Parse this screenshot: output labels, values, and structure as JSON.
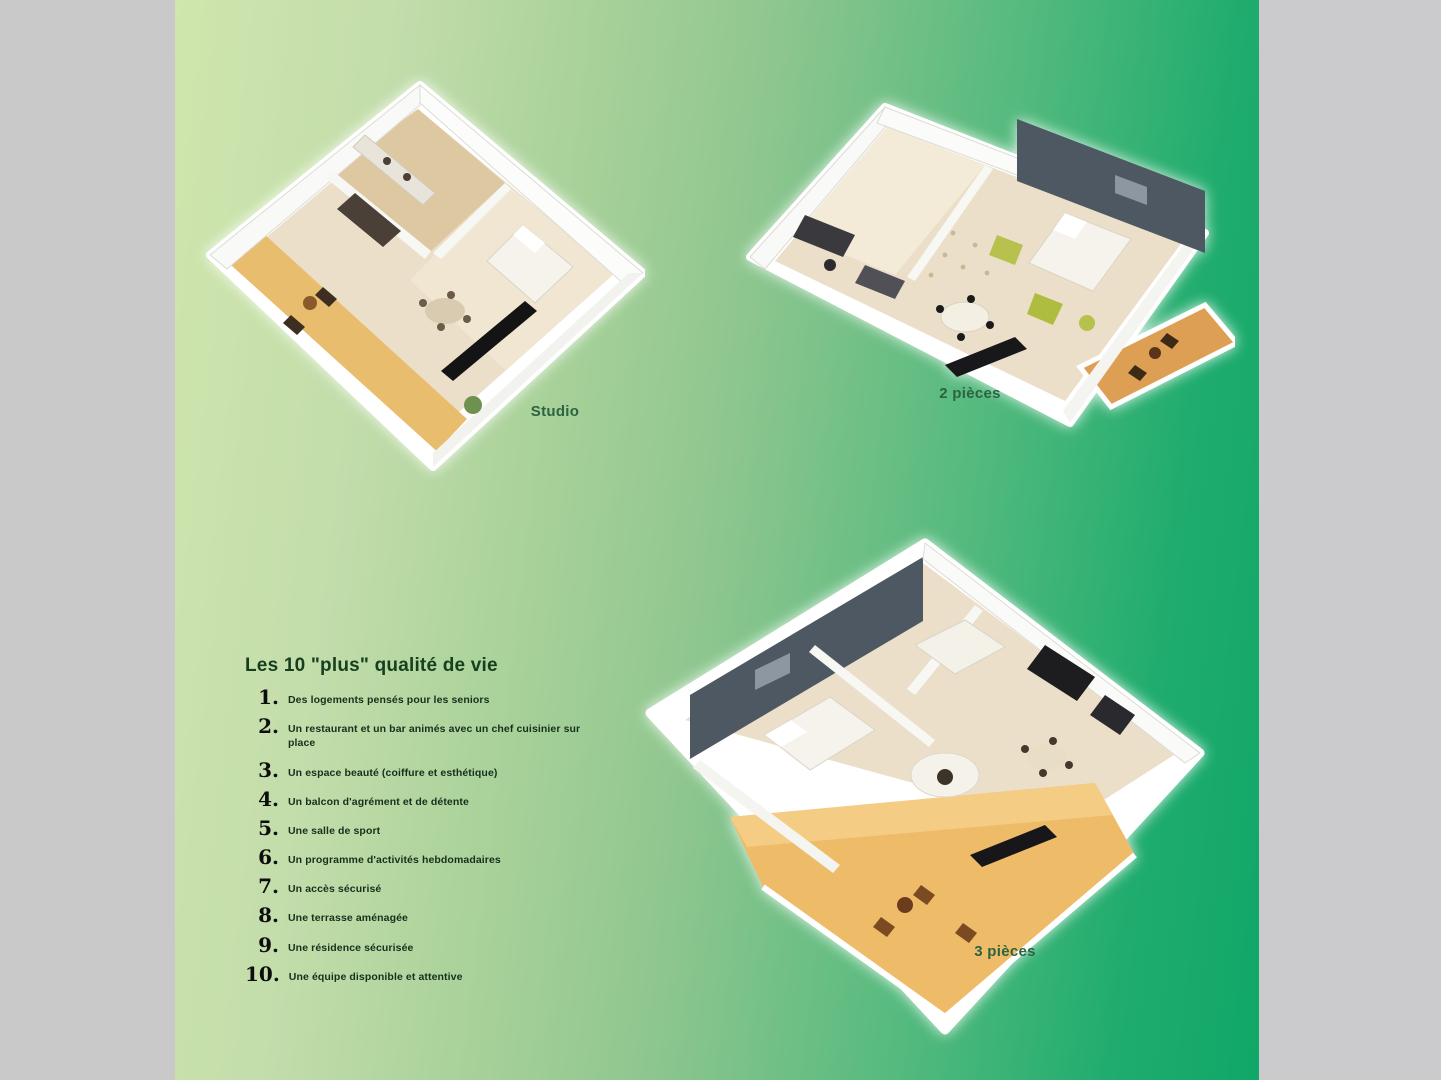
{
  "page": {
    "background_color": "#c9c9c9",
    "panel_gradient_left": "#cfe6ac",
    "panel_gradient_mid": "#8ec68f",
    "panel_gradient_right": "#10a768",
    "right_margin_color": "#cbcacd"
  },
  "plans": [
    {
      "id": "studio",
      "label": "Studio"
    },
    {
      "id": "2-pieces",
      "label": "2 pièces"
    },
    {
      "id": "3-pieces",
      "label": "3 pièces"
    }
  ],
  "features": {
    "title": "Les 10 \"plus\" qualité de vie",
    "items": [
      {
        "num": "1.",
        "text": "Des logements pensés pour les seniors"
      },
      {
        "num": "2.",
        "text": "Un restaurant et un bar animés avec un chef cuisinier sur place"
      },
      {
        "num": "3.",
        "text": "Un espace beauté (coiffure et esthétique)"
      },
      {
        "num": "4.",
        "text": "Un balcon d'agrément et de détente"
      },
      {
        "num": "5.",
        "text": "Une salle de sport"
      },
      {
        "num": "6.",
        "text": "Un programme d'activités hebdomadaires"
      },
      {
        "num": "7.",
        "text": "Un accès sécurisé"
      },
      {
        "num": "8.",
        "text": "Une terrasse aménagée"
      },
      {
        "num": "9.",
        "text": "Une résidence sécurisée"
      },
      {
        "num": "10.",
        "text": "Une équipe disponible et attentive"
      }
    ]
  },
  "illustration_colors": {
    "floor_beige": "#ecdfc9",
    "wood": "#ddc8a2",
    "balcony_orange": "#e9bd6e",
    "terrace_orange": "#eebb68",
    "accent_wall_slate": "#4e5862",
    "furniture_green": "#b7c24e",
    "furniture_dark": "#1d1d1f",
    "wall_white": "#f9f9f7"
  }
}
